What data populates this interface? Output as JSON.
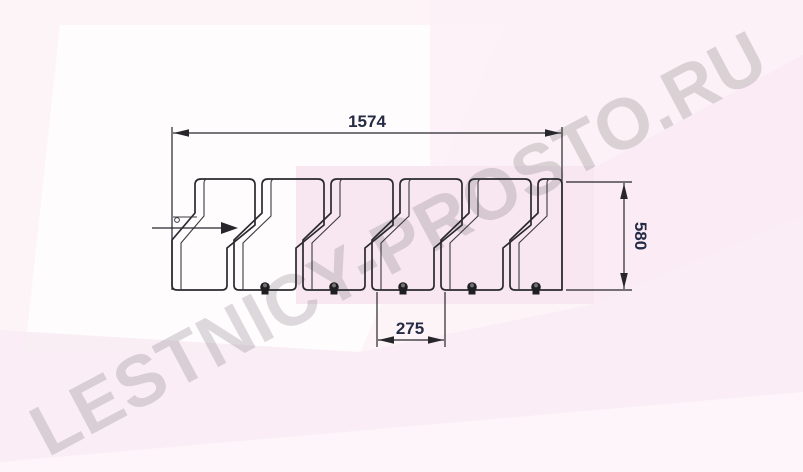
{
  "watermark": {
    "text": "LESTNICY-PROSTO.RU"
  },
  "drawing": {
    "type": "technical-dimension-drawing",
    "subject": "row of 6 staircase modules, side view",
    "dimensions": {
      "overall_width": {
        "value": "1574"
      },
      "overall_height": {
        "value": "580"
      },
      "module_pitch": {
        "value": "275"
      }
    },
    "modules": {
      "count": 6,
      "bolt_count": 5
    },
    "icons": [
      "flow-direction-arrow-icon",
      "bolt-icon",
      "pivot-circle-icon"
    ]
  },
  "colors": {
    "background_base": "#fdf5f9",
    "background_white_zone": "#fffdfe",
    "background_pink_block": "#f7e4ef",
    "background_pink_band": "#f9ebf4",
    "line": "#2a2a2e",
    "dimension_text": "#252b44",
    "watermark": "#8e888c"
  }
}
